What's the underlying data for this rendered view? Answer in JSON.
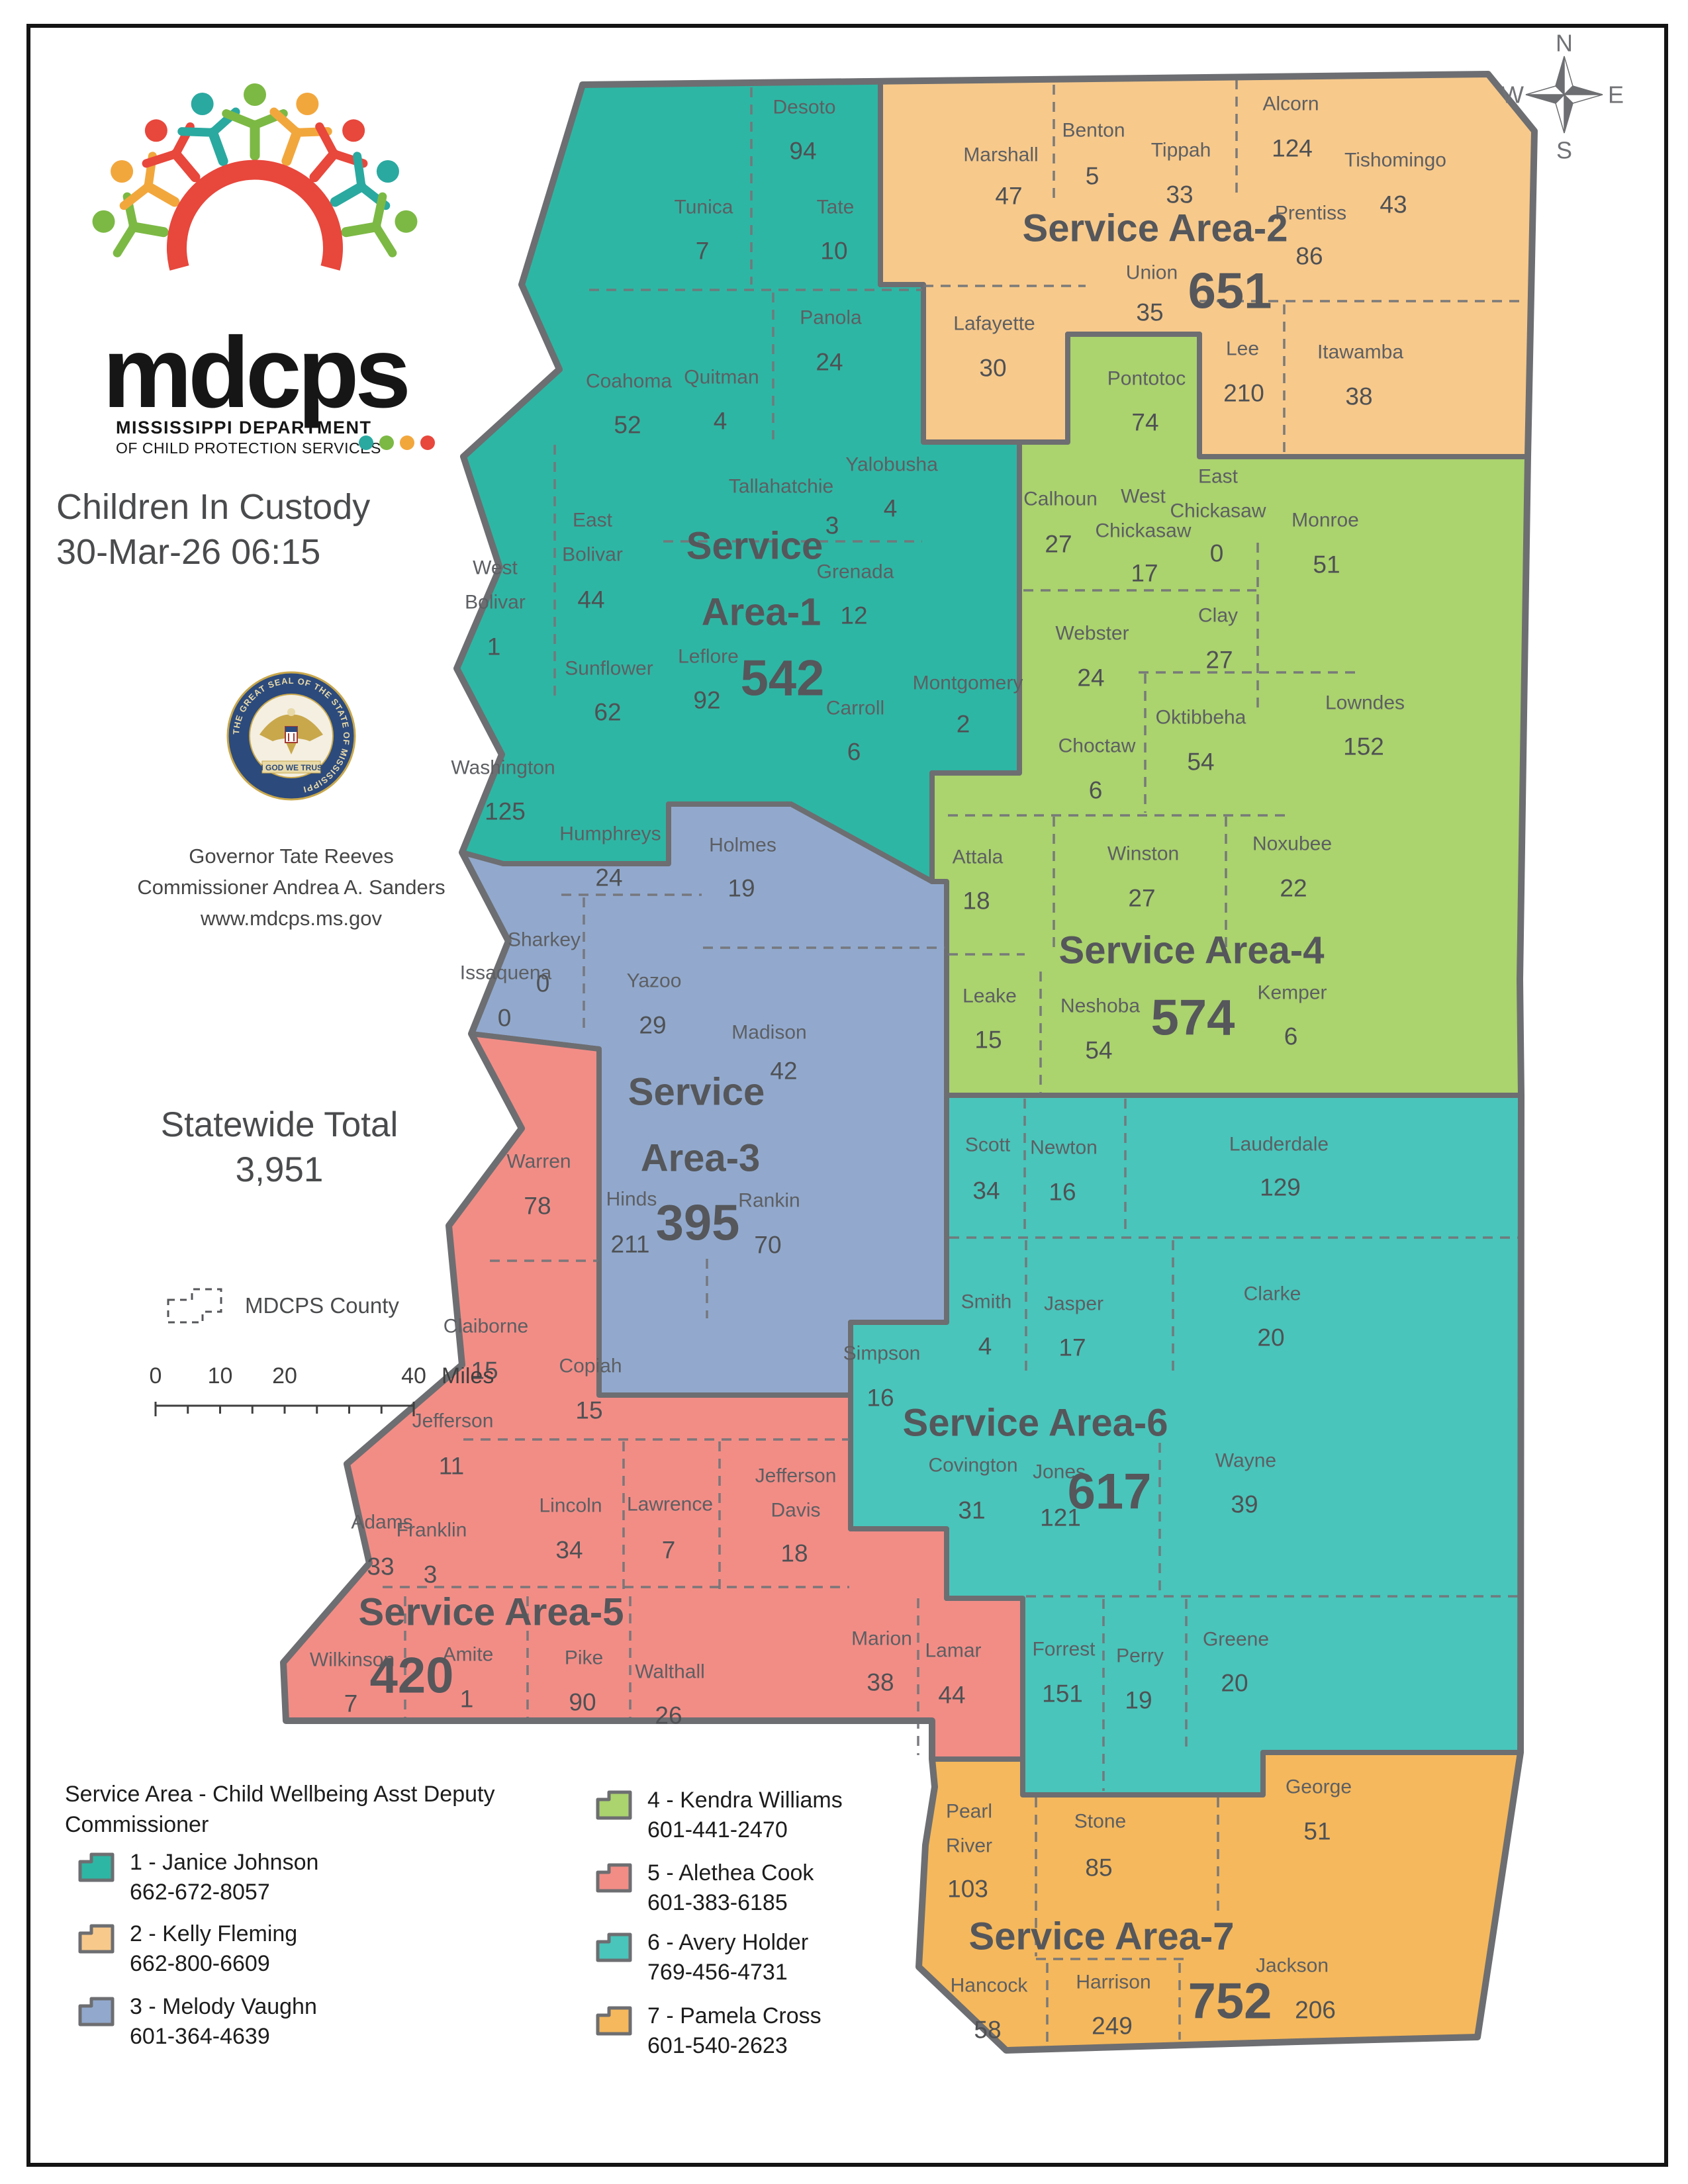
{
  "logo": {
    "name": "mdcps",
    "tagline_line1": "MISSISSIPPI DEPARTMENT",
    "tagline_line2": "OF CHILD PROTECTION SERVICES",
    "colors": [
      "#7cb944",
      "#f2a73d",
      "#e8473c",
      "#2aa9a0"
    ]
  },
  "page": {
    "title": "Children In Custody",
    "datetime": "30-Mar-26 06:15"
  },
  "seal": {
    "ring_text": "THE GREAT SEAL OF THE STATE OF MISSISSIPPI",
    "banner_text": "IN GOD WE TRUST"
  },
  "info": {
    "line1": "Governor Tate Reeves",
    "line2": "Commissioner Andrea A. Sanders",
    "line3": "www.mdcps.ms.gov"
  },
  "statewide": {
    "label": "Statewide Total",
    "value": "3,951"
  },
  "map_key": {
    "label": "MDCPS County"
  },
  "scale_bar": {
    "ticks": [
      "0",
      "10",
      "20",
      "40"
    ],
    "unit": "Miles"
  },
  "compass": {
    "n": "N",
    "e": "E",
    "s": "S",
    "w": "W"
  },
  "areas": [
    {
      "id": 1,
      "label": "Service Area-1",
      "total": "542",
      "color": "#2eb6a4",
      "counties": [
        {
          "name": "Desoto",
          "value": "94"
        },
        {
          "name": "Tunica",
          "value": "7"
        },
        {
          "name": "Tate",
          "value": "10"
        },
        {
          "name": "Coahoma",
          "value": "52"
        },
        {
          "name": "Quitman",
          "value": "4"
        },
        {
          "name": "Panola",
          "value": "24"
        },
        {
          "name": "Tallahatchie",
          "value": "3"
        },
        {
          "name": "Yalobusha",
          "value": "4"
        },
        {
          "name": "East Bolivar",
          "value": "44"
        },
        {
          "name": "West Bolivar",
          "value": "1"
        },
        {
          "name": "Sunflower",
          "value": "62"
        },
        {
          "name": "Leflore",
          "value": "92"
        },
        {
          "name": "Grenada",
          "value": "12"
        },
        {
          "name": "Carroll",
          "value": "6"
        },
        {
          "name": "Montgomery",
          "value": "2"
        },
        {
          "name": "Washington",
          "value": "125"
        }
      ]
    },
    {
      "id": 2,
      "label": "Service Area-2",
      "total": "651",
      "color": "#f7c98b",
      "counties": [
        {
          "name": "Marshall",
          "value": "47"
        },
        {
          "name": "Benton",
          "value": "5"
        },
        {
          "name": "Tippah",
          "value": "33"
        },
        {
          "name": "Alcorn",
          "value": "124"
        },
        {
          "name": "Tishomingo",
          "value": "43"
        },
        {
          "name": "Prentiss",
          "value": "86"
        },
        {
          "name": "Union",
          "value": "35"
        },
        {
          "name": "Lafayette",
          "value": "30"
        },
        {
          "name": "Lee",
          "value": "210"
        },
        {
          "name": "Itawamba",
          "value": "38"
        }
      ]
    },
    {
      "id": 3,
      "label": "Service Area-3",
      "total": "395",
      "color": "#92a9cd",
      "counties": [
        {
          "name": "Humphreys",
          "value": "24"
        },
        {
          "name": "Holmes",
          "value": "19"
        },
        {
          "name": "Sharkey",
          "value": "0"
        },
        {
          "name": "Issaquena",
          "value": "0"
        },
        {
          "name": "Yazoo",
          "value": "29"
        },
        {
          "name": "Madison",
          "value": "42"
        },
        {
          "name": "Hinds",
          "value": "211"
        },
        {
          "name": "Rankin",
          "value": "70"
        }
      ]
    },
    {
      "id": 4,
      "label": "Service Area-4",
      "total": "574",
      "color": "#abd36e",
      "counties": [
        {
          "name": "Pontotoc",
          "value": "74"
        },
        {
          "name": "Calhoun",
          "value": "27"
        },
        {
          "name": "West Chickasaw",
          "value": "17"
        },
        {
          "name": "East Chickasaw",
          "value": "0"
        },
        {
          "name": "Monroe",
          "value": "51"
        },
        {
          "name": "Webster",
          "value": "24"
        },
        {
          "name": "Clay",
          "value": "27"
        },
        {
          "name": "Oktibbeha",
          "value": "54"
        },
        {
          "name": "Choctaw",
          "value": "6"
        },
        {
          "name": "Lowndes",
          "value": "152"
        },
        {
          "name": "Attala",
          "value": "18"
        },
        {
          "name": "Winston",
          "value": "27"
        },
        {
          "name": "Noxubee",
          "value": "22"
        },
        {
          "name": "Leake",
          "value": "15"
        },
        {
          "name": "Neshoba",
          "value": "54"
        },
        {
          "name": "Kemper",
          "value": "6"
        }
      ]
    },
    {
      "id": 5,
      "label": "Service Area-5",
      "total": "420",
      "color": "#f28d86",
      "counties": [
        {
          "name": "Warren",
          "value": "78"
        },
        {
          "name": "Claiborne",
          "value": "15"
        },
        {
          "name": "Copiah",
          "value": "15"
        },
        {
          "name": "Jefferson",
          "value": "11"
        },
        {
          "name": "Adams",
          "value": "33"
        },
        {
          "name": "Franklin",
          "value": "3"
        },
        {
          "name": "Lincoln",
          "value": "34"
        },
        {
          "name": "Lawrence",
          "value": "7"
        },
        {
          "name": "Jefferson Davis",
          "value": "18"
        },
        {
          "name": "Wilkinson",
          "value": "7"
        },
        {
          "name": "Amite",
          "value": "1"
        },
        {
          "name": "Pike",
          "value": "90"
        },
        {
          "name": "Walthall",
          "value": "26"
        },
        {
          "name": "Marion",
          "value": "38"
        },
        {
          "name": "Lamar",
          "value": "44"
        }
      ]
    },
    {
      "id": 6,
      "label": "Service Area-6",
      "total": "617",
      "color": "#49c5bb",
      "counties": [
        {
          "name": "Scott",
          "value": "34"
        },
        {
          "name": "Newton",
          "value": "16"
        },
        {
          "name": "Lauderdale",
          "value": "129"
        },
        {
          "name": "Smith",
          "value": "4"
        },
        {
          "name": "Jasper",
          "value": "17"
        },
        {
          "name": "Clarke",
          "value": "20"
        },
        {
          "name": "Simpson",
          "value": "16"
        },
        {
          "name": "Covington",
          "value": "31"
        },
        {
          "name": "Jones",
          "value": "121"
        },
        {
          "name": "Wayne",
          "value": "39"
        },
        {
          "name": "Forrest",
          "value": "151"
        },
        {
          "name": "Perry",
          "value": "19"
        },
        {
          "name": "Greene",
          "value": "20"
        }
      ]
    },
    {
      "id": 7,
      "label": "Service Area-7",
      "total": "752",
      "color": "#f5b85c",
      "counties": [
        {
          "name": "Pearl River",
          "value": "103"
        },
        {
          "name": "Stone",
          "value": "85"
        },
        {
          "name": "George",
          "value": "51"
        },
        {
          "name": "Hancock",
          "value": "58"
        },
        {
          "name": "Harrison",
          "value": "249"
        },
        {
          "name": "Jackson",
          "value": "206"
        }
      ]
    }
  ],
  "legend": {
    "title": "Service Area - Child Wellbeing Asst Deputy Commissioner",
    "items": [
      {
        "label": "1 - Janice Johnson",
        "phone": "662-672-8057",
        "color": "#2eb6a4"
      },
      {
        "label": "2 - Kelly Fleming",
        "phone": "662-800-6609",
        "color": "#f7c98b"
      },
      {
        "label": "3 - Melody Vaughn",
        "phone": "601-364-4639",
        "color": "#92a9cd"
      },
      {
        "label": "4 - Kendra Williams",
        "phone": "601-441-2470",
        "color": "#abd36e"
      },
      {
        "label": "5 - Alethea Cook",
        "phone": "601-383-6185",
        "color": "#f28d86"
      },
      {
        "label": "6 - Avery Holder",
        "phone": "769-456-4731",
        "color": "#49c5bb"
      },
      {
        "label": "7 - Pamela Cross",
        "phone": "601-540-2623",
        "color": "#f5b85c"
      }
    ]
  }
}
